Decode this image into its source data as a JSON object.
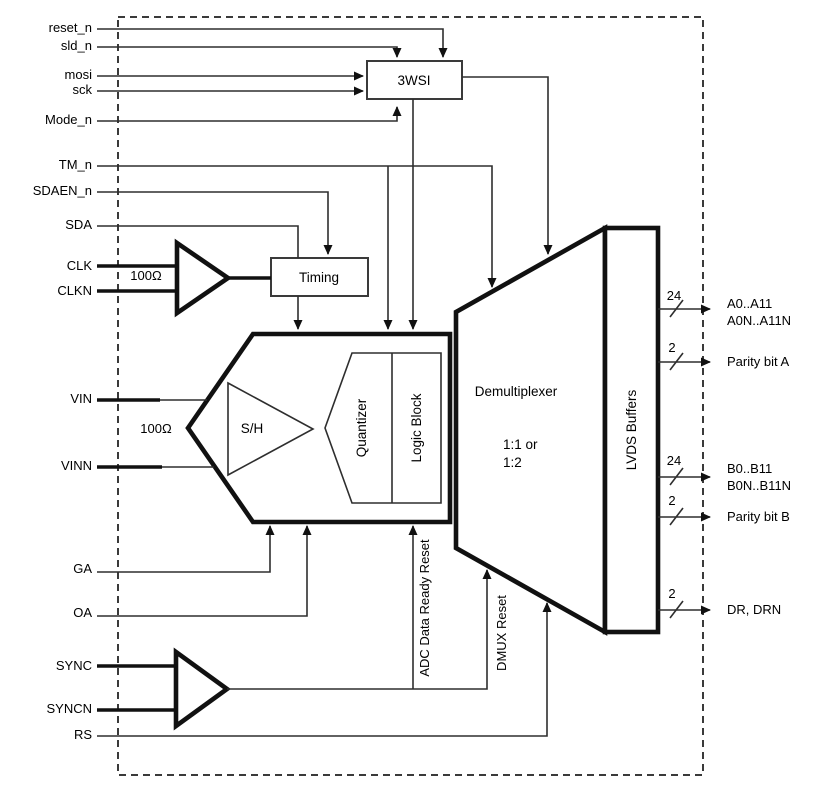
{
  "inputs": [
    {
      "label": "reset_n"
    },
    {
      "label": "sld_n"
    },
    {
      "label": "mosi"
    },
    {
      "label": "sck"
    },
    {
      "label": "Mode_n"
    },
    {
      "label": "TM_n"
    },
    {
      "label": "SDAEN_n"
    },
    {
      "label": "SDA"
    },
    {
      "label": "CLK"
    },
    {
      "label": "CLKN"
    },
    {
      "label": "VIN"
    },
    {
      "label": "VINN"
    },
    {
      "label": "GA"
    },
    {
      "label": "OA"
    },
    {
      "label": "SYNC"
    },
    {
      "label": "SYNCN"
    },
    {
      "label": "RS"
    }
  ],
  "blocks": {
    "wsi": "3WSI",
    "timing": "Timing",
    "sample_hold": "S/H",
    "quantizer": "Quantizer",
    "logic_block": "Logic Block",
    "demux_title": "Demultiplexer",
    "demux_ratio_line1": "1:1 or",
    "demux_ratio_line2": "1:2",
    "lvds": "LVDS Buffers"
  },
  "annotations": {
    "clk_termination": "100Ω",
    "vin_termination": "100Ω",
    "adc_data_ready_reset": "ADC Data Ready Reset",
    "dmux_reset": "DMUX Reset"
  },
  "outputs": [
    {
      "width": "24",
      "line1": "A0..A11",
      "line2": "A0N..A11N"
    },
    {
      "width": "2",
      "line1": "Parity bit A"
    },
    {
      "width": "24",
      "line1": "B0..B11",
      "line2": "B0N..B11N"
    },
    {
      "width": "2",
      "line1": "Parity bit B"
    },
    {
      "width": "2",
      "line1": "DR, DRN"
    }
  ],
  "colors": {
    "background": "#ffffff",
    "line": "#2e2e2e",
    "heavy_outline": "#111111",
    "box_stroke": "#3a3a3a",
    "dashed_border": "#3a3a3a",
    "text": "#000000"
  }
}
